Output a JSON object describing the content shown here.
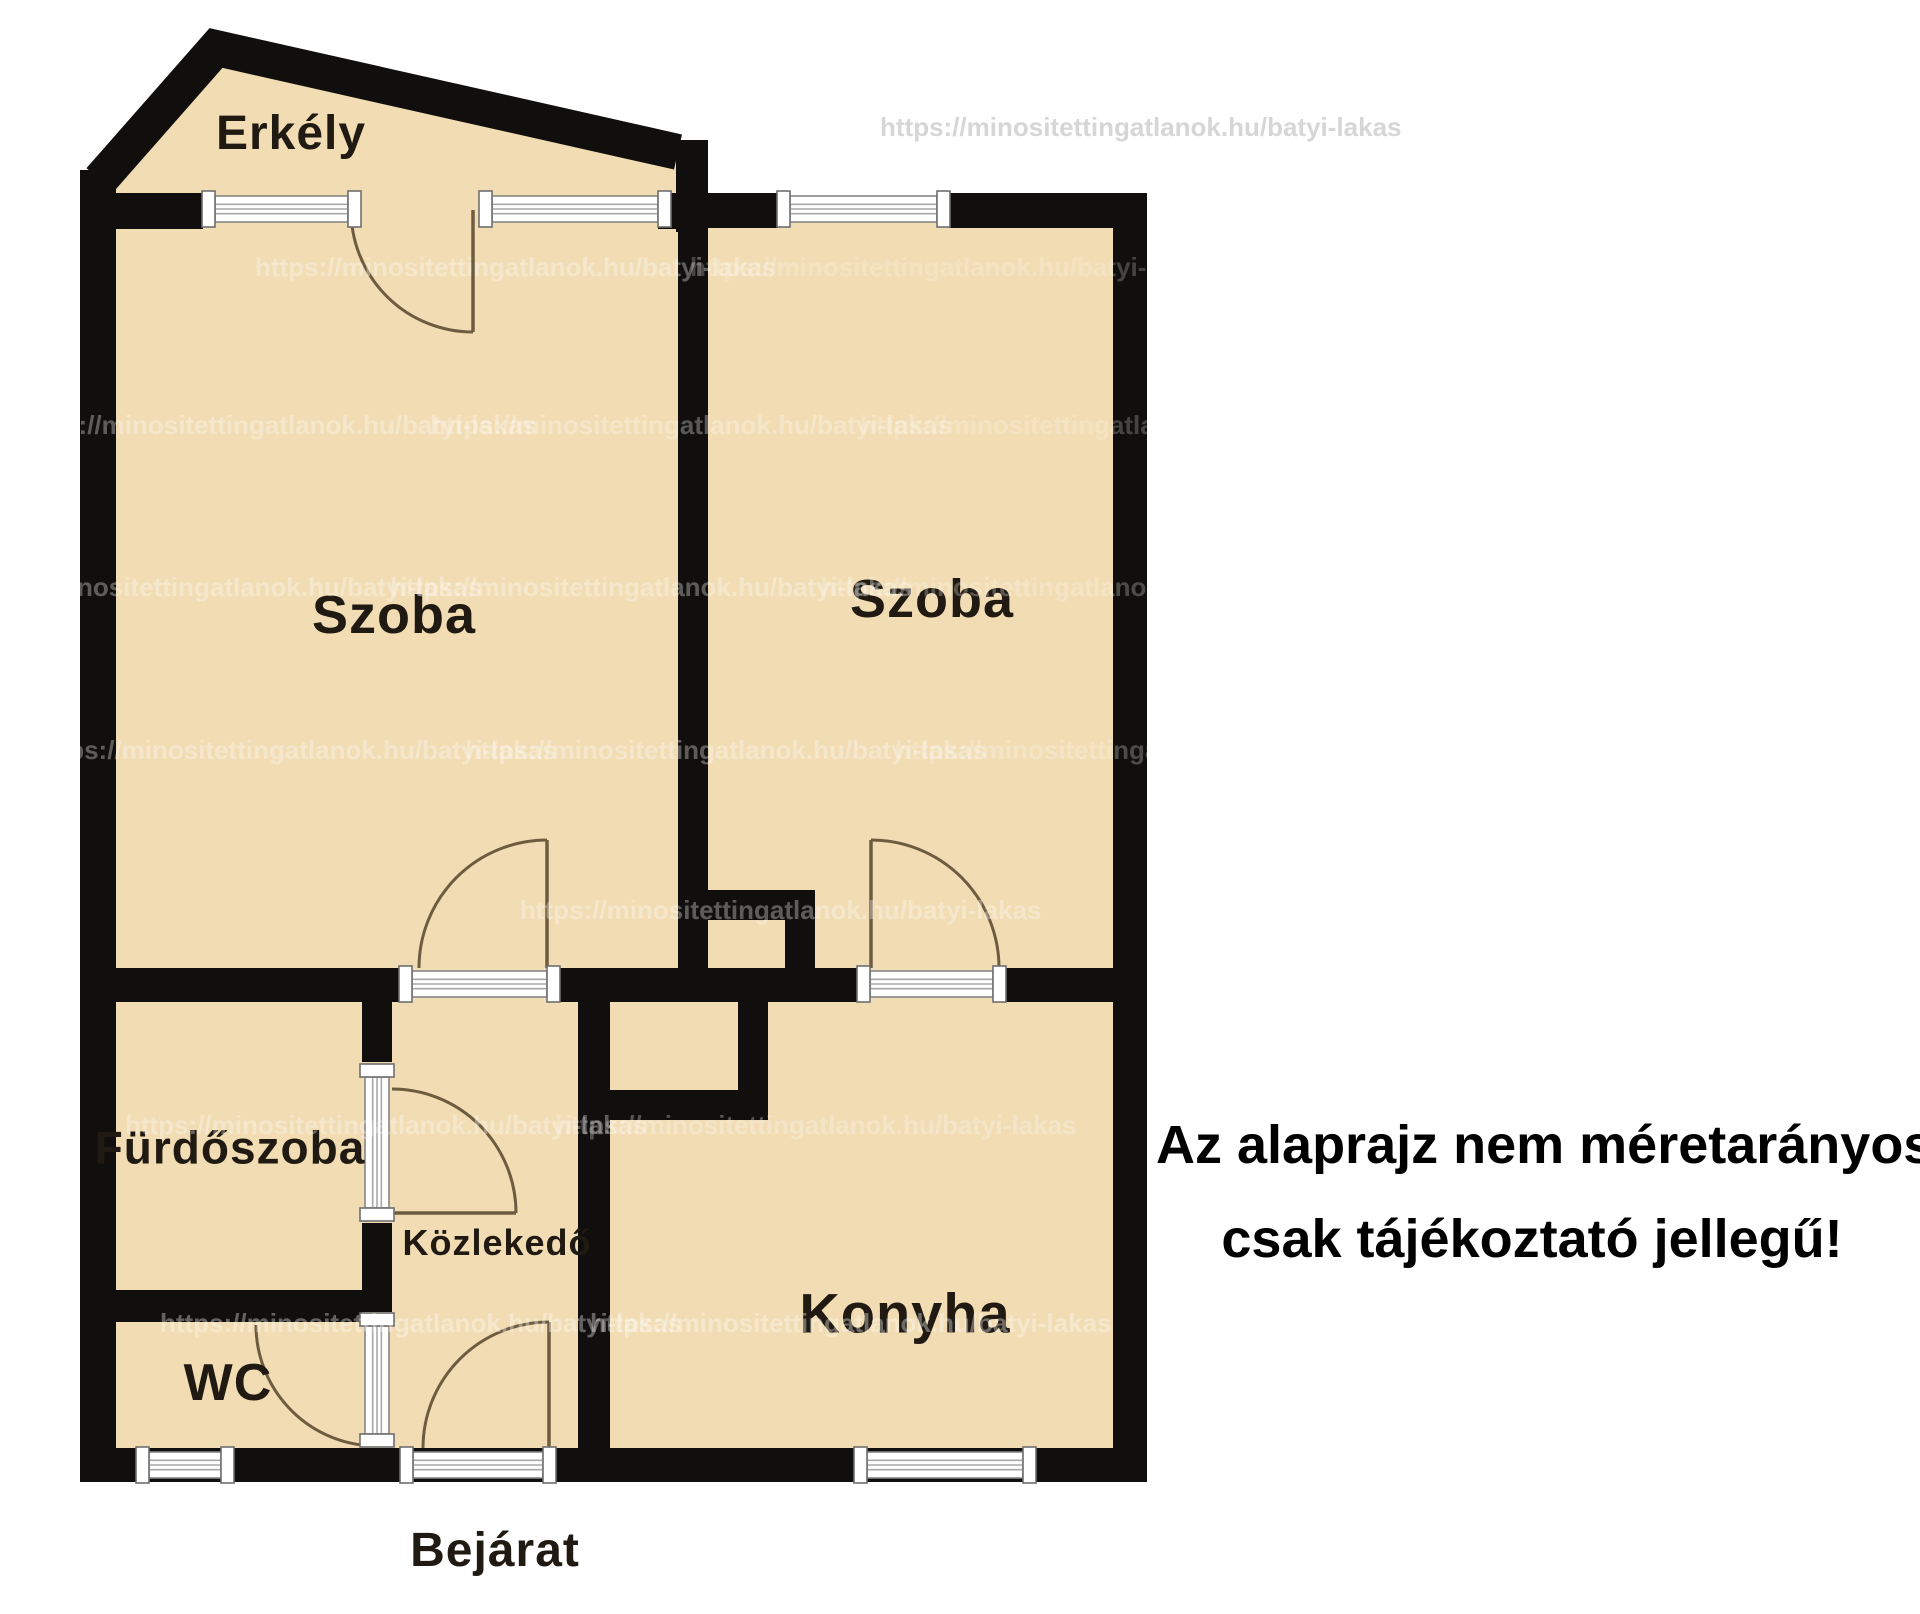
{
  "page_title": "Alaprajz",
  "disclaimer": {
    "line1": "Az alaprajz nem méretarányos,",
    "line2": "csak tájékoztató jellegű!"
  },
  "watermark": {
    "text": "https://minositettingatlanok.hu/batyi-lakas",
    "instances": [
      {
        "x": 880,
        "y": 112,
        "color": "#d4d4d4",
        "opacity": 0.95
      },
      {
        "x": 255,
        "y": 252,
        "color": "#ffffff",
        "opacity": 0.33
      },
      {
        "x": 690,
        "y": 252,
        "color": "#ffffff",
        "opacity": 0.22
      },
      {
        "x": 15,
        "y": 410,
        "color": "#ffffff",
        "opacity": 0.32
      },
      {
        "x": 430,
        "y": 410,
        "color": "#ffffff",
        "opacity": 0.3
      },
      {
        "x": 860,
        "y": 410,
        "color": "#ffffff",
        "opacity": 0.22
      },
      {
        "x": -40,
        "y": 572,
        "color": "#ffffff",
        "opacity": 0.32
      },
      {
        "x": 390,
        "y": 572,
        "color": "#ffffff",
        "opacity": 0.32
      },
      {
        "x": 820,
        "y": 572,
        "color": "#ffffff",
        "opacity": 0.25
      },
      {
        "x": 35,
        "y": 735,
        "color": "#ffffff",
        "opacity": 0.32
      },
      {
        "x": 465,
        "y": 735,
        "color": "#ffffff",
        "opacity": 0.32
      },
      {
        "x": 895,
        "y": 735,
        "color": "#ffffff",
        "opacity": 0.25
      },
      {
        "x": 520,
        "y": 895,
        "color": "#ffffff",
        "opacity": 0.32
      },
      {
        "x": 125,
        "y": 1110,
        "color": "#ffffff",
        "opacity": 0.32
      },
      {
        "x": 555,
        "y": 1110,
        "color": "#ffffff",
        "opacity": 0.28
      },
      {
        "x": 160,
        "y": 1308,
        "color": "#ffffff",
        "opacity": 0.35
      },
      {
        "x": 590,
        "y": 1308,
        "color": "#ffffff",
        "opacity": 0.35
      }
    ]
  },
  "plan": {
    "wall_color": "#100f0d",
    "floor_color": "#f1dcb3",
    "door_color": "#6d5c40",
    "window_frame_color": "#868686",
    "window_line_color": "#a8a8a8",
    "label_color": "#201a12",
    "fills": {
      "balcony_polygon": [
        [
          98,
          185
        ],
        [
          214,
          44
        ],
        [
          680,
          150
        ],
        [
          680,
          232
        ],
        [
          98,
          232
        ]
      ],
      "main_rect": [
        98,
        196,
        1032,
        1270
      ]
    },
    "roof_polyline": [
      [
        100,
        180
      ],
      [
        216,
        48
      ],
      [
        678,
        152
      ]
    ],
    "roof_stroke": 36,
    "walls": [
      [
        80,
        170,
        36,
        1312
      ],
      [
        80,
        1448,
        1067,
        34
      ],
      [
        1113,
        193,
        34,
        1289
      ],
      [
        676,
        140,
        32,
        92
      ],
      [
        116,
        193,
        87,
        36
      ],
      [
        658,
        193,
        22,
        36
      ],
      [
        676,
        193,
        102,
        35
      ],
      [
        949,
        193,
        164,
        35
      ],
      [
        116,
        968,
        284,
        34
      ],
      [
        558,
        968,
        299,
        34
      ],
      [
        1005,
        968,
        108,
        34
      ],
      [
        678,
        222,
        30,
        753
      ],
      [
        708,
        890,
        107,
        30
      ],
      [
        785,
        920,
        30,
        55
      ],
      [
        362,
        1002,
        30,
        60
      ],
      [
        362,
        1223,
        30,
        89
      ],
      [
        116,
        1290,
        246,
        32
      ],
      [
        578,
        1002,
        32,
        446
      ],
      [
        578,
        1090,
        190,
        30
      ],
      [
        738,
        1002,
        30,
        118
      ]
    ],
    "windows": [
      {
        "name": "balcony-window-left",
        "x": 215,
        "y": 196,
        "w": 133,
        "h": 26,
        "o": "h"
      },
      {
        "name": "balcony-window-right",
        "x": 492,
        "y": 196,
        "w": 166,
        "h": 26,
        "o": "h"
      },
      {
        "name": "room-right-top-window",
        "x": 790,
        "y": 196,
        "w": 147,
        "h": 26,
        "o": "h"
      },
      {
        "name": "wc-window",
        "x": 149,
        "y": 1452,
        "w": 72,
        "h": 26,
        "o": "h"
      },
      {
        "name": "kitchen-window",
        "x": 867,
        "y": 1452,
        "w": 156,
        "h": 26,
        "o": "h"
      },
      {
        "name": "room-left-door-sill",
        "x": 412,
        "y": 971,
        "w": 135,
        "h": 26,
        "o": "h"
      },
      {
        "name": "room-right-door-sill",
        "x": 870,
        "y": 971,
        "w": 123,
        "h": 26,
        "o": "h"
      },
      {
        "name": "entrance-door-sill",
        "x": 413,
        "y": 1452,
        "w": 130,
        "h": 26,
        "o": "h"
      },
      {
        "name": "bathroom-door-panel",
        "x": 365,
        "y": 1077,
        "w": 24,
        "h": 131,
        "o": "v"
      },
      {
        "name": "wc-door-panel",
        "x": 365,
        "y": 1326,
        "w": 24,
        "h": 108,
        "o": "v"
      }
    ],
    "doors": [
      {
        "name": "balcony-door",
        "leaf": [
          473,
          210,
          473,
          332
        ],
        "arc": [
          351,
          210,
          473,
          332,
          122,
          0
        ]
      },
      {
        "name": "room-left-door",
        "leaf": [
          547,
          840,
          547,
          968
        ],
        "arc": [
          547,
          840,
          419,
          968,
          128,
          0
        ]
      },
      {
        "name": "room-right-door",
        "leaf": [
          871,
          840,
          871,
          968
        ],
        "arc": [
          871,
          840,
          999,
          968,
          128,
          1
        ]
      },
      {
        "name": "bathroom-door",
        "leaf": [
          392,
          1213,
          516,
          1213
        ],
        "arc": [
          392,
          1089,
          516,
          1213,
          124,
          1
        ]
      },
      {
        "name": "wc-door",
        "leaf": null,
        "arc": [
          256,
          1325,
          377,
          1446,
          121,
          0
        ]
      },
      {
        "name": "entrance-door",
        "leaf": [
          549,
          1322,
          549,
          1448
        ],
        "arc": [
          549,
          1322,
          423,
          1448,
          126,
          0
        ]
      }
    ],
    "labels": [
      {
        "text": "Erkély",
        "x": 291,
        "y": 136,
        "size": 48
      },
      {
        "text": "Szoba",
        "x": 394,
        "y": 618,
        "size": 54
      },
      {
        "text": "Szoba",
        "x": 932,
        "y": 602,
        "size": 54
      },
      {
        "text": "Fürdőszoba",
        "x": 230,
        "y": 1150,
        "size": 46
      },
      {
        "text": "Közlekedő",
        "x": 497,
        "y": 1245,
        "size": 36
      },
      {
        "text": "Konyha",
        "x": 905,
        "y": 1316,
        "size": 56
      },
      {
        "text": "WC",
        "x": 228,
        "y": 1386,
        "size": 52
      },
      {
        "text": "Bejárat",
        "x": 495,
        "y": 1553,
        "size": 48
      }
    ]
  }
}
